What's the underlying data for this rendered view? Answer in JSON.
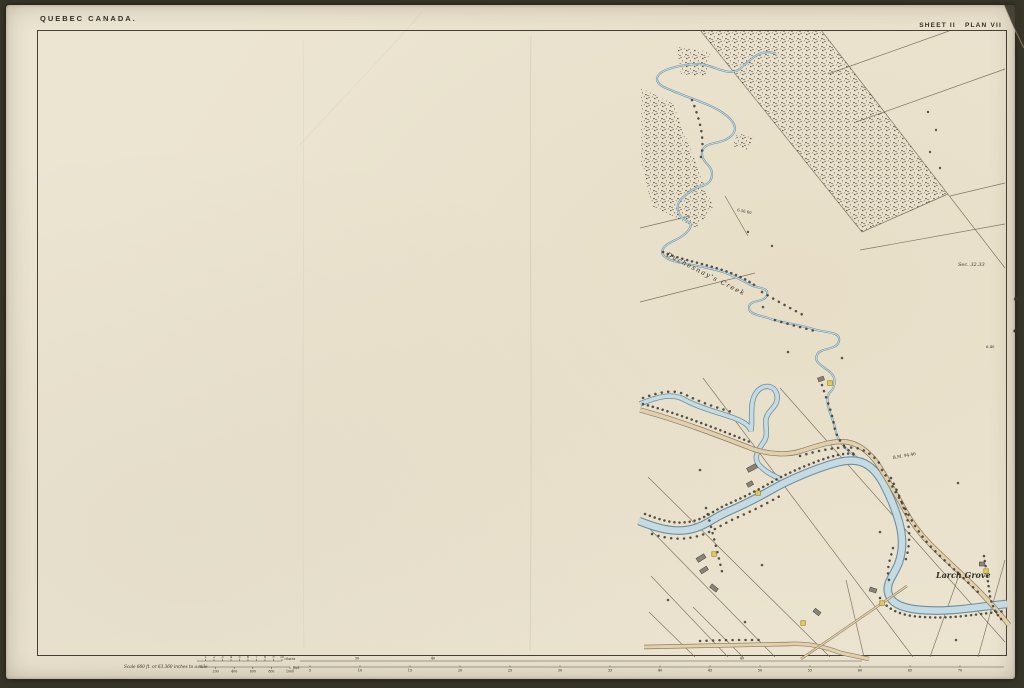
{
  "page": {
    "region_label": "QUEBEC CANADA.",
    "sheet_label": "SHEET II   PLAN VII"
  },
  "map_labels": {
    "creek_name": "Duchesnay's Creek",
    "grove": "Larch Grove",
    "section": "Sec. 32.33",
    "benchmark": "B.M. 94.46",
    "elevation_a": "6.56.60",
    "elevation_b": "6.40"
  },
  "scale_bar": {
    "caption": "Scale 660 ft. or 63.360 inches to a mile",
    "chain_labels": [
      "1",
      "2",
      "3",
      "4",
      "5",
      "6",
      "7",
      "8",
      "9",
      "10"
    ],
    "chain_unit": "chains",
    "feet_labels": [
      "200",
      "400",
      "600",
      "800",
      "1000"
    ],
    "feet_unit": "feet"
  },
  "baseline": {
    "station_numbers": [
      "5",
      "10",
      "15",
      "20",
      "25",
      "30",
      "35",
      "40",
      "45",
      "50",
      "55",
      "60",
      "65",
      "70"
    ],
    "upper_marks": [
      {
        "x": 357,
        "label": "30"
      },
      {
        "x": 433,
        "label": "40"
      },
      {
        "x": 742,
        "label": "40"
      }
    ]
  },
  "colors": {
    "paper": "#ece5d2",
    "surround": "#373428",
    "ink": "#332f27",
    "lot_line": "#6f6554",
    "water_edge": "#6a8fa4",
    "water_fill": "#c5dbe1",
    "road_edge": "#8e7b5e",
    "road_fill": "#e1d0ae",
    "woods_ink": "#44403a",
    "building_gray": "#8a8477",
    "building_yellow": "#e3cc52",
    "crease": "#9a8f74"
  }
}
